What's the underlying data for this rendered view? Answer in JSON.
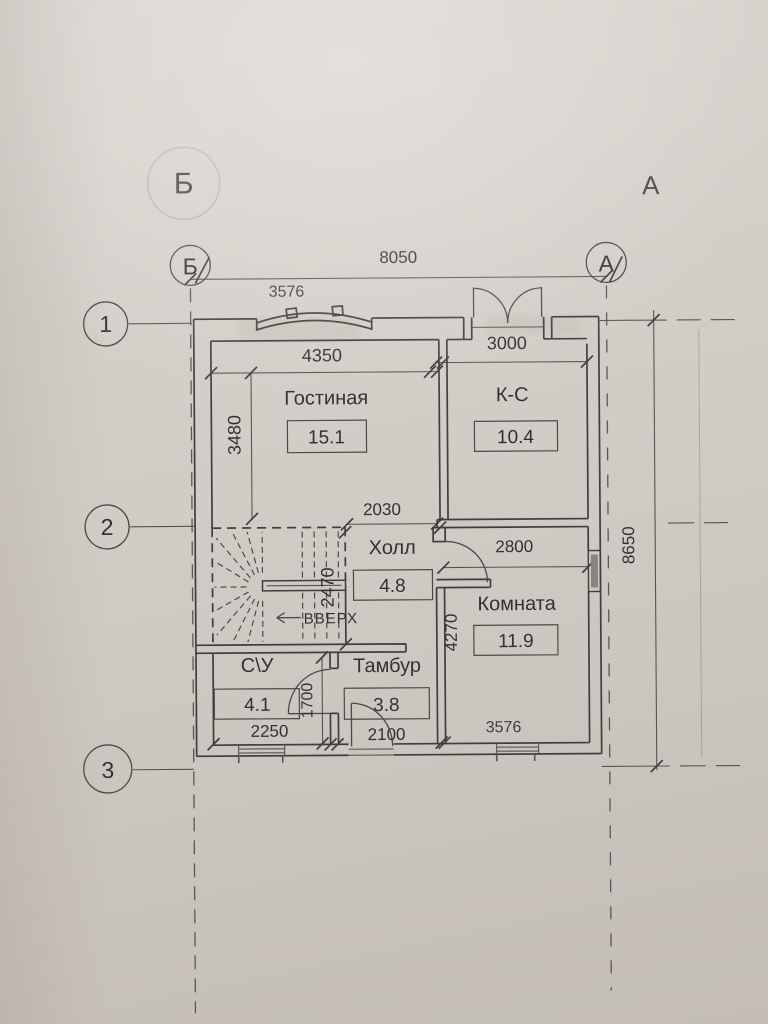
{
  "plan": {
    "grid": {
      "col_left": "Б",
      "col_right": "А",
      "row_1": "1",
      "row_2": "2",
      "row_3": "3"
    },
    "dims": {
      "overall_width": "8050",
      "overall_height": "8650",
      "living_width": "4350",
      "living_depth": "3480",
      "kitchen_width": "3000",
      "opening_width": "2030",
      "stairs_depth": "2470",
      "room_width": "2800",
      "room_depth": "4270",
      "su_depth": "1700",
      "su_width": "2250",
      "tambur_width": "2100"
    },
    "rooms": {
      "living": {
        "name": "Гостиная",
        "area": "15.1"
      },
      "kitchen": {
        "name": "К-С",
        "area": "10.4"
      },
      "hall": {
        "name": "Холл",
        "area": "4.8"
      },
      "room": {
        "name": "Комната",
        "area": "11.9"
      },
      "su": {
        "name": "С\\У",
        "area": "4.1"
      },
      "tambur": {
        "name": "Тамбур",
        "area": "3.8"
      }
    },
    "stairs_label": "ВВЕРХ",
    "bleed": {
      "axis_b": "Б",
      "axis_a": "А",
      "num_top": "3576",
      "num_bottom": "3576"
    }
  }
}
